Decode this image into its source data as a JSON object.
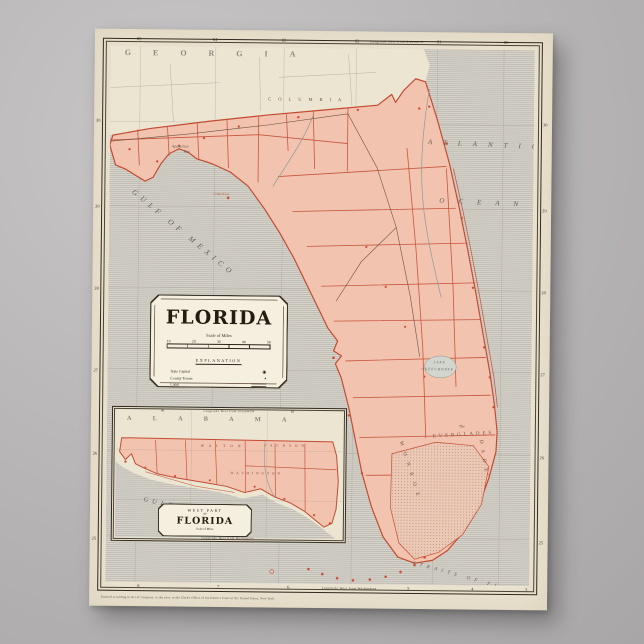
{
  "map": {
    "title": "FLORIDA",
    "scale_label": "Scale of Miles",
    "scale_ticks": [
      "10",
      "20",
      "30",
      "40",
      "50"
    ],
    "legend_title": "EXPLANATION",
    "legend": [
      {
        "label": "State Capital",
        "symbol": "capital-star"
      },
      {
        "label": "County Towns",
        "symbol": "town-dot"
      },
      {
        "label": "Canal",
        "symbol": "canal-line"
      },
      {
        "label": "Rail Road",
        "symbol": "railroad-line"
      },
      {
        "label": "Common Road",
        "symbol": "dashed-road-line"
      }
    ]
  },
  "labels": {
    "georgia": "GEORGIA",
    "atlantic": "ATLANTIC",
    "ocean": "OCEAN",
    "gulf_of_mexico": "GULF OF MEXICO",
    "apalachee_1": "Apalachee",
    "apalachee_2": "Bay",
    "columbia": "COLUMBIA",
    "monroe": "MONROE",
    "dade": "DADE",
    "everglades_the": "The",
    "everglades": "EVERGLADES",
    "lake": "LAKE",
    "okeechobee": "OKEECHOBEE",
    "straits": "STRAITS OF FLORIDA",
    "cedar_keys": "Cedar Keys"
  },
  "borders": {
    "top_label": "Longitude West from Greenwich",
    "bottom_label": "Longitude West from Washington",
    "top_lon": [
      "85",
      "84",
      "83",
      "82",
      "81",
      "80"
    ],
    "bottom_lon": [
      "8",
      "7",
      "6",
      "5",
      "4",
      "3"
    ],
    "left_lat": [
      "30",
      "29",
      "28",
      "27",
      "26",
      "25"
    ],
    "right_lat": [
      "30",
      "29",
      "28",
      "27",
      "26",
      "25"
    ]
  },
  "inset": {
    "title_top": "WEST PART",
    "title_of": "OF",
    "title_main": "FLORIDA",
    "scale_label": "Scale of Miles",
    "alabama": "ALABAMA",
    "gulf": "GULF OF MEXICO",
    "county_walton": "WALTON",
    "county_washington": "WASHINGTON",
    "county_jackson": "JACKSON",
    "top_label": "Longitude West from Greenwich",
    "bottom_label": "Longitude West from Washington",
    "top_ticks": [
      "86",
      "85"
    ]
  },
  "footer": {
    "copyright": "Entered according to Act of Congress, in the year, in the Clerk's Office of the District Court of the United States, New York."
  },
  "colors": {
    "land": "#f2c3ae",
    "boundary": "#c44a32",
    "sea_line": "#a8a49a",
    "paper": "#ebe4d1",
    "photo_background": "#b7b4b5"
  }
}
